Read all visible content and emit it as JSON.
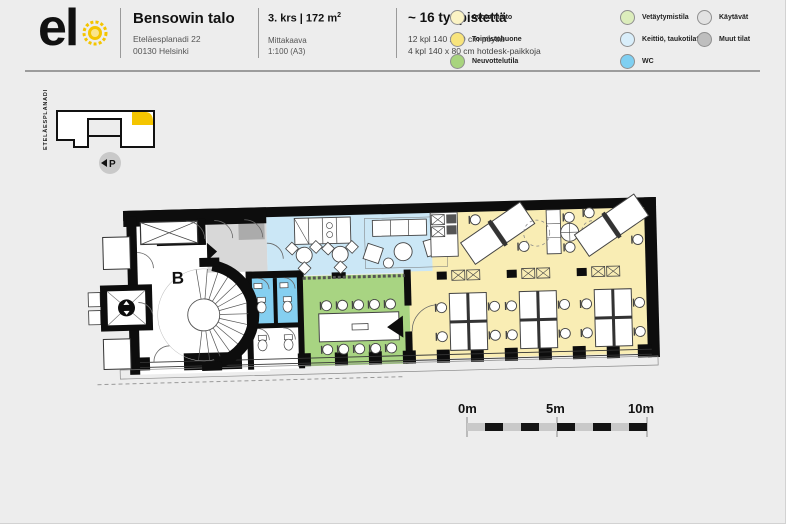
{
  "header": {
    "logo": {
      "text": "el",
      "sun_color": "#F4C500"
    },
    "building": {
      "name": "Bensowin talo",
      "address1": "Eteläesplanadi 22",
      "address2": "00130 Helsinki"
    },
    "floor": {
      "title": "3. krs | 172 m",
      "area_sup": "2",
      "scale_label": "Mittakaava",
      "scale_value": "1:100 (A3)"
    },
    "capacity": {
      "title": "~ 16 työpistettä",
      "line1": "12 kpl 140 x 80 cm pöytiä",
      "line2": "4 kpl 140 x 80 cm hotdesk-paikkoja"
    },
    "legend": {
      "items": [
        {
          "label": "Avotoimisto",
          "dot": "background:#FBF3C4"
        },
        {
          "label": "Toimistohuone",
          "dot": "background:#F8E47C"
        },
        {
          "label": "Neuvottelutila",
          "dot": "background:#A8D47E"
        },
        {
          "label": "Vetäytymistila",
          "dot": "background:#DCEDBC"
        },
        {
          "label": "Keittiö, taukotilat",
          "dot": "background:#D9EEFA"
        },
        {
          "label": "WC",
          "dot": "background:#7FCFF1"
        },
        {
          "label": "Käytävät",
          "dot": "background:#E2E2E2"
        },
        {
          "label": "Muut tilat",
          "dot": "background:#BEBEBE"
        }
      ]
    }
  },
  "site_map": {
    "street": "ETELÄESPLANADI",
    "parking": "P",
    "highlight": "#F4C500"
  },
  "plan": {
    "stairwell_label": "B",
    "colors": {
      "open_office": "#F9EDB4",
      "lounge": "#CBE7F6",
      "wc": "#85CFF0",
      "meeting": "#A8D482",
      "corridor": "#D8D8D8",
      "corridor_dark": "#ABABAB",
      "wall": "#0d0d0d"
    }
  },
  "scale_bar": {
    "labels": [
      "0m",
      "5m",
      "10m"
    ]
  }
}
